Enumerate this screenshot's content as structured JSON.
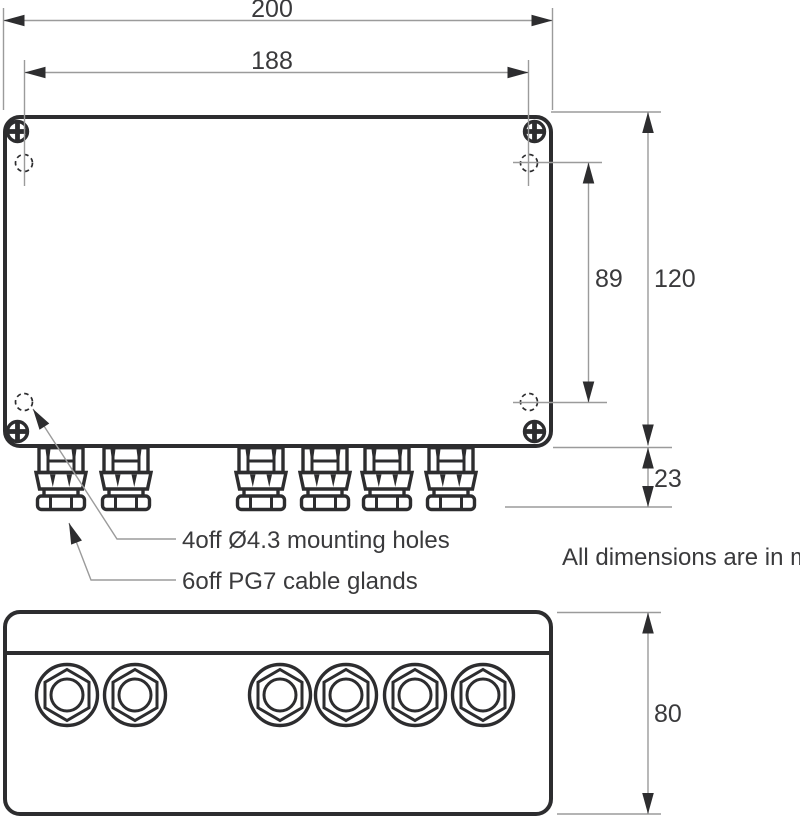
{
  "drawing": {
    "title_note": "All dimensions are in mm",
    "dimensions": {
      "overall_width_mm": "200",
      "hole_spacing_width_mm": "188",
      "hole_spacing_depth_mm": "89",
      "overall_depth_mm": "120",
      "gland_protrusion_mm": "23",
      "front_height_mm": "80"
    },
    "callouts": {
      "mounting_holes": "4off Ø4.3 mounting holes",
      "cable_glands": "6off PG7 cable glands"
    },
    "features": {
      "screw_count": 4,
      "mounting_hole_count": 4,
      "cable_gland_count": 6
    },
    "colors": {
      "outline": "#2d2d2f",
      "dimension_line": "#9b9b9b",
      "arrow": "#2d2d2f",
      "text": "#3a3a3c",
      "background": "#ffffff"
    }
  }
}
